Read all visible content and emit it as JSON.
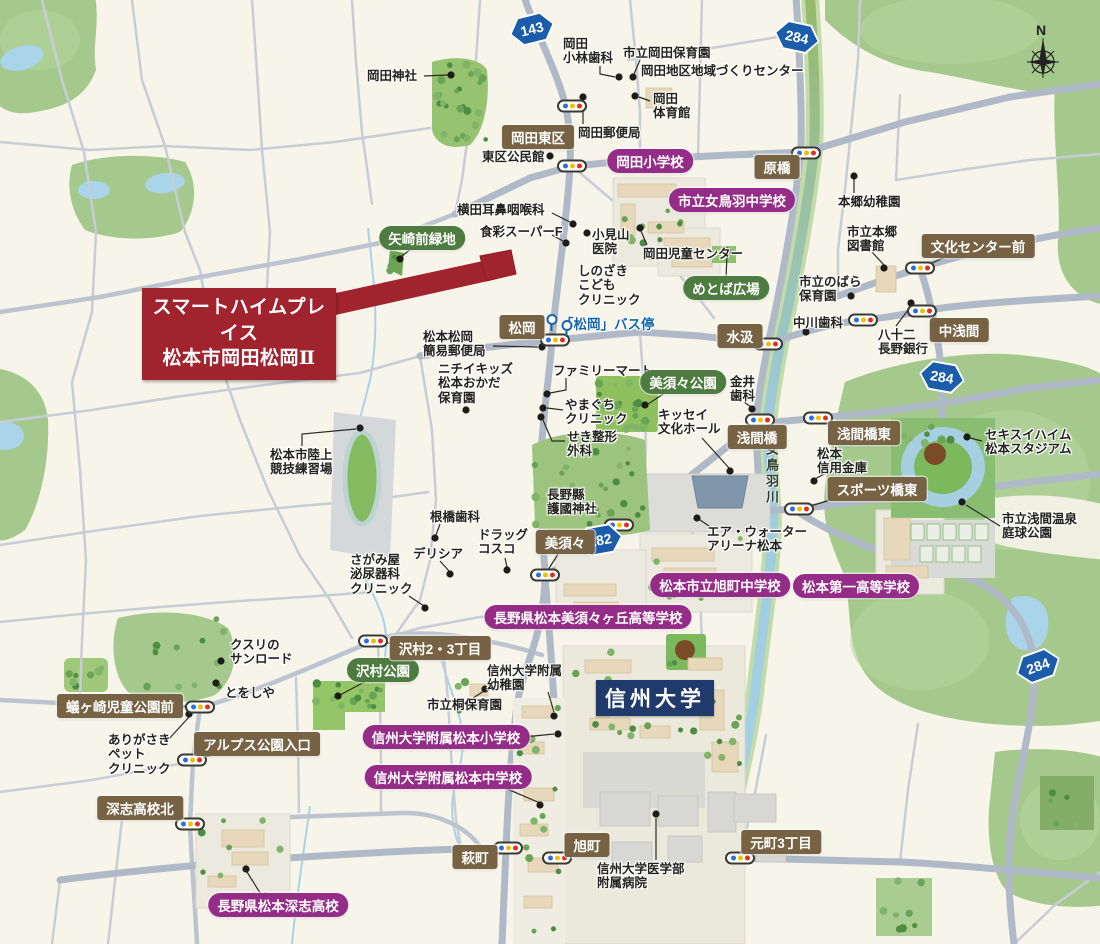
{
  "property": {
    "name_line1": "スマートハイムプレイス",
    "name_line2": "松本市岡田松岡Ⅱ"
  },
  "university": {
    "label": "信州大学"
  },
  "river": {
    "label": "女鳥羽川"
  },
  "compass": {
    "label": "N"
  },
  "bus_stop": {
    "label": "「松岡」バス停",
    "icons": [
      [
        551,
        316
      ],
      [
        566,
        322
      ]
    ]
  },
  "route_shields": [
    {
      "num": "143",
      "x": 532,
      "y": 29,
      "rot": -14
    },
    {
      "num": "284",
      "x": 797,
      "y": 37,
      "rot": 12
    },
    {
      "num": "284",
      "x": 942,
      "y": 377,
      "rot": 10
    },
    {
      "num": "282",
      "x": 600,
      "y": 540,
      "rot": -10
    },
    {
      "num": "284",
      "x": 1038,
      "y": 666,
      "rot": -20
    }
  ],
  "school_badges": [
    {
      "label": "岡田小学校",
      "x": 650,
      "y": 161
    },
    {
      "label": "市立女鳥羽中学校",
      "x": 732,
      "y": 200
    },
    {
      "label": "長野県松本美須々ヶ丘高等学校",
      "x": 588,
      "y": 617
    },
    {
      "label": "松本市立旭町中学校",
      "x": 720,
      "y": 585
    },
    {
      "label": "松本第一高等学校",
      "x": 856,
      "y": 586
    },
    {
      "label": "信州大学附属松本小学校",
      "x": 446,
      "y": 737,
      "dot": [
        558,
        734
      ],
      "leader": [
        [
          524,
          737
        ],
        [
          554,
          734
        ]
      ]
    },
    {
      "label": "信州大学附属松本中学校",
      "x": 448,
      "y": 777,
      "dot": [
        540,
        805
      ],
      "leader": [
        [
          505,
          788
        ],
        [
          540,
          803
        ]
      ]
    },
    {
      "label": "長野県松本深志高校",
      "x": 278,
      "y": 905,
      "dot": [
        246,
        869
      ],
      "leader": [
        [
          262,
          896
        ],
        [
          247,
          872
        ]
      ]
    }
  ],
  "park_badges": [
    {
      "label": "矢崎前緑地",
      "x": 422,
      "y": 238,
      "dot": [
        400,
        259
      ],
      "leader": [
        [
          412,
          248
        ],
        [
          401,
          257
        ]
      ]
    },
    {
      "label": "めとば広場",
      "x": 726,
      "y": 288,
      "dot": [
        727,
        251
      ],
      "leader": [
        [
          726,
          279
        ],
        [
          727,
          254
        ]
      ]
    },
    {
      "label": "美須々公園",
      "x": 683,
      "y": 382,
      "dot": [
        645,
        405
      ],
      "leader": [
        [
          668,
          391
        ],
        [
          648,
          404
        ]
      ]
    },
    {
      "label": "沢村公園",
      "x": 383,
      "y": 670,
      "dot": [
        338,
        696
      ],
      "leader": [
        [
          370,
          679
        ],
        [
          340,
          695
        ]
      ]
    }
  ],
  "place_badges": [
    {
      "label": "岡田東区",
      "x": 538,
      "y": 137
    },
    {
      "label": "原橋",
      "x": 777,
      "y": 167,
      "leader": [
        [
          790,
          160
        ],
        [
          801,
          156
        ]
      ]
    },
    {
      "label": "文化センター前",
      "x": 978,
      "y": 246,
      "leader": [
        [
          952,
          254
        ],
        [
          928,
          265
        ]
      ]
    },
    {
      "label": "中浅間",
      "x": 959,
      "y": 330,
      "leader": [
        [
          942,
          322
        ],
        [
          927,
          314
        ]
      ]
    },
    {
      "label": "水汲",
      "x": 740,
      "y": 336,
      "leader": [
        [
          754,
          338
        ],
        [
          764,
          342
        ]
      ]
    },
    {
      "label": "松岡",
      "x": 522,
      "y": 327,
      "leader": [
        [
          534,
          334
        ],
        [
          550,
          338
        ]
      ]
    },
    {
      "label": "浅間橋",
      "x": 757,
      "y": 437
    },
    {
      "label": "浅間橋東",
      "x": 864,
      "y": 433,
      "leader": [
        [
          846,
          426
        ],
        [
          824,
          420
        ]
      ]
    },
    {
      "label": "スポーツ橋東",
      "x": 877,
      "y": 489,
      "leader": [
        [
          840,
          497
        ],
        [
          804,
          508
        ]
      ]
    },
    {
      "label": "美須々",
      "x": 565,
      "y": 542,
      "leader": [
        [
          560,
          551
        ],
        [
          548,
          570
        ]
      ]
    },
    {
      "label": "沢村2・3丁目",
      "x": 440,
      "y": 648,
      "leader": [
        [
          404,
          646
        ],
        [
          382,
          642
        ]
      ]
    },
    {
      "label": "蟻ヶ崎児童公園前",
      "x": 120,
      "y": 706,
      "leader": [
        [
          180,
          706
        ],
        [
          191,
          707
        ]
      ]
    },
    {
      "label": "アルプス公園入口",
      "x": 257,
      "y": 744,
      "leader": [
        [
          230,
          752
        ],
        [
          198,
          758
        ]
      ]
    },
    {
      "label": "深志高校北",
      "x": 140,
      "y": 808,
      "leader": [
        [
          166,
          816
        ],
        [
          186,
          821
        ]
      ]
    },
    {
      "label": "萩町",
      "x": 475,
      "y": 857,
      "leader": [
        [
          488,
          852
        ],
        [
          500,
          849
        ]
      ]
    },
    {
      "label": "旭町",
      "x": 587,
      "y": 845,
      "leader": [
        [
          573,
          851
        ],
        [
          562,
          856
        ]
      ]
    },
    {
      "label": "元町3丁目",
      "x": 781,
      "y": 842,
      "leader": [
        [
          762,
          850
        ],
        [
          744,
          855
        ]
      ]
    }
  ],
  "poi_labels": [
    {
      "text": "岡田神社",
      "x": 367,
      "y": 69,
      "dot": [
        451,
        75
      ],
      "leader": [
        [
          424,
          76
        ],
        [
          448,
          75
        ]
      ]
    },
    {
      "text": "岡田\n小林歯科",
      "x": 563,
      "y": 37,
      "dot": [
        619,
        77
      ],
      "leader": [
        [
          600,
          66
        ],
        [
          600,
          74
        ],
        [
          615,
          77
        ]
      ]
    },
    {
      "text": "市立岡田保育園",
      "x": 623,
      "y": 46,
      "dot": [
        633,
        77
      ],
      "leader": [
        [
          640,
          60
        ],
        [
          634,
          74
        ]
      ]
    },
    {
      "text": "岡田地区地域づくりセンター",
      "x": 641,
      "y": 64
    },
    {
      "text": "岡田\n体育館",
      "x": 653,
      "y": 92,
      "dot": [
        635,
        96
      ],
      "leader": [
        [
          650,
          101
        ],
        [
          639,
          97
        ]
      ]
    },
    {
      "text": "岡田郵便局",
      "x": 578,
      "y": 126,
      "dot": [
        583,
        97
      ],
      "leader": [
        [
          583,
          124
        ],
        [
          583,
          101
        ]
      ]
    },
    {
      "text": "東区公民館",
      "x": 482,
      "y": 150,
      "dot": [
        550,
        156
      ]
    },
    {
      "text": "横田耳鼻咽喉科",
      "x": 457,
      "y": 203,
      "dot": [
        573,
        224
      ],
      "leader": [
        [
          552,
          213
        ],
        [
          570,
          222
        ]
      ]
    },
    {
      "text": "食彩スーパーF",
      "x": 480,
      "y": 225,
      "dot": [
        566,
        243
      ],
      "leader": [
        [
          552,
          235
        ],
        [
          563,
          241
        ]
      ]
    },
    {
      "text": "小見山\n医院",
      "x": 592,
      "y": 228,
      "dot": [
        587,
        233
      ]
    },
    {
      "text": "岡田児童センター",
      "x": 643,
      "y": 247,
      "dot": [
        640,
        228
      ],
      "leader": [
        [
          647,
          245
        ],
        [
          641,
          231
        ]
      ]
    },
    {
      "text": "しのざき\nこども\nクリニック",
      "x": 578,
      "y": 264
    },
    {
      "text": "本郷幼稚園",
      "x": 838,
      "y": 195,
      "dot": [
        854,
        176
      ],
      "leader": [
        [
          854,
          193
        ],
        [
          854,
          179
        ]
      ]
    },
    {
      "text": "市立本郷\n図書館",
      "x": 847,
      "y": 225,
      "dot": [
        884,
        268
      ],
      "leader": [
        [
          872,
          252
        ],
        [
          884,
          265
        ]
      ]
    },
    {
      "text": "市立のばら\n保育園",
      "x": 799,
      "y": 275,
      "dot": [
        851,
        296
      ]
    },
    {
      "text": "中川歯科",
      "x": 793,
      "y": 316,
      "dot": [
        806,
        332
      ]
    },
    {
      "text": "八十二\n長野銀行",
      "x": 878,
      "y": 328,
      "dot": [
        911,
        303
      ],
      "leader": [
        [
          896,
          326
        ],
        [
          911,
          306
        ]
      ]
    },
    {
      "text": "松本松岡\n簡易郵便局",
      "x": 423,
      "y": 330,
      "dot": [
        542,
        347
      ],
      "leader": [
        [
          493,
          346
        ],
        [
          538,
          347
        ]
      ]
    },
    {
      "text": "ニチイキッズ\n松本おかだ\n保育園",
      "x": 438,
      "y": 362,
      "dot": [
        466,
        410
      ]
    },
    {
      "text": "ファミリーマート",
      "x": 553,
      "y": 364,
      "dot": [
        547,
        394
      ],
      "leader": [
        [
          566,
          378
        ],
        [
          566,
          390
        ],
        [
          550,
          393
        ]
      ]
    },
    {
      "text": "やまぐち\nクリニック",
      "x": 565,
      "y": 398,
      "dot": [
        543,
        408
      ],
      "leader": [
        [
          563,
          410
        ],
        [
          547,
          408
        ]
      ]
    },
    {
      "text": "せき整形\n外科",
      "x": 567,
      "y": 430,
      "dot": [
        541,
        417
      ],
      "leader": [
        [
          565,
          441
        ],
        [
          552,
          441
        ],
        [
          543,
          420
        ]
      ]
    },
    {
      "text": "金井\n歯科",
      "x": 730,
      "y": 375,
      "dot": [
        752,
        409
      ],
      "leader": [
        [
          744,
          402
        ],
        [
          751,
          407
        ]
      ]
    },
    {
      "text": "キッセイ\n文化ホール",
      "x": 658,
      "y": 408,
      "dot": [
        730,
        471
      ],
      "leader": [
        [
          702,
          438
        ],
        [
          729,
          468
        ]
      ]
    },
    {
      "text": "松本市陸上\n競技練習場",
      "x": 270,
      "y": 448,
      "dot": [
        360,
        428
      ],
      "leader": [
        [
          302,
          446
        ],
        [
          302,
          434
        ],
        [
          356,
          429
        ]
      ]
    },
    {
      "text": "根橋歯科",
      "x": 430,
      "y": 510,
      "dot": [
        435,
        538
      ],
      "leader": [
        [
          440,
          524
        ],
        [
          436,
          535
        ]
      ]
    },
    {
      "text": "デリシア",
      "x": 413,
      "y": 547,
      "dot": [
        450,
        574
      ],
      "leader": [
        [
          440,
          561
        ],
        [
          449,
          571
        ]
      ]
    },
    {
      "text": "ドラッグ\nコスコ",
      "x": 478,
      "y": 528,
      "dot": [
        507,
        570
      ],
      "leader": [
        [
          505,
          558
        ],
        [
          507,
          567
        ]
      ]
    },
    {
      "text": "さがみ屋\n泌尿器科\nクリニック",
      "x": 350,
      "y": 553,
      "dot": [
        425,
        608
      ],
      "leader": [
        [
          409,
          596
        ],
        [
          424,
          606
        ]
      ]
    },
    {
      "text": "長野縣\n護國神社",
      "x": 547,
      "y": 488
    },
    {
      "text": "エア・ウォーター\nアリーナ松本",
      "x": 707,
      "y": 525,
      "dot": [
        697,
        518
      ],
      "leader": [
        [
          712,
          528
        ],
        [
          700,
          520
        ]
      ]
    },
    {
      "text": "セキスイハイム\n松本スタジアム",
      "x": 985,
      "y": 428,
      "dot": [
        967,
        437
      ],
      "leader": [
        [
          982,
          441
        ],
        [
          970,
          438
        ]
      ]
    },
    {
      "text": "松本\n信用金庫",
      "x": 817,
      "y": 447,
      "dot": [
        814,
        481
      ],
      "leader": [
        [
          826,
          473
        ],
        [
          815,
          479
        ]
      ]
    },
    {
      "text": "市立浅間温泉\n庭球公園",
      "x": 1002,
      "y": 512,
      "dot": [
        962,
        502
      ],
      "leader": [
        [
          1000,
          526
        ],
        [
          966,
          505
        ]
      ]
    },
    {
      "text": "クスリの\nサンロード",
      "x": 230,
      "y": 638,
      "dot": [
        221,
        661
      ]
    },
    {
      "text": "とをしや",
      "x": 225,
      "y": 686,
      "dot": [
        216,
        683
      ]
    },
    {
      "text": "ありがさき\nペット\nクリニック",
      "x": 108,
      "y": 733,
      "dot": [
        189,
        714
      ],
      "leader": [
        [
          168,
          740
        ],
        [
          189,
          717
        ]
      ]
    },
    {
      "text": "市立桐保育園",
      "x": 427,
      "y": 698,
      "dot": [
        485,
        689
      ],
      "leader": [
        [
          470,
          700
        ],
        [
          484,
          691
        ]
      ]
    },
    {
      "text": "信州大学附属\n幼稚園",
      "x": 487,
      "y": 664,
      "dot": [
        554,
        716
      ],
      "leader": [
        [
          548,
          692
        ],
        [
          554,
          712
        ]
      ]
    },
    {
      "text": "信州大学医学部\n附属病院",
      "x": 597,
      "y": 862,
      "dot": [
        656,
        814
      ],
      "leader": [
        [
          656,
          860
        ],
        [
          656,
          818
        ]
      ]
    }
  ],
  "signals": [
    [
      572,
      106
    ],
    [
      572,
      166
    ],
    [
      806,
      153
    ],
    [
      920,
      268
    ],
    [
      922,
      311
    ],
    [
      863,
      320
    ],
    [
      768,
      344
    ],
    [
      555,
      340
    ],
    [
      760,
      420
    ],
    [
      818,
      418
    ],
    [
      799,
      509
    ],
    [
      619,
      525
    ],
    [
      545,
      575
    ],
    [
      373,
      641
    ],
    [
      200,
      707
    ],
    [
      192,
      760
    ],
    [
      190,
      824
    ],
    [
      508,
      848
    ],
    [
      557,
      858
    ],
    [
      740,
      858
    ]
  ],
  "colors": {
    "background": "#f7f4ea",
    "road": "#afb9c7",
    "road_minor": "#c6cdd6",
    "forest": "#a5c98d",
    "park": "#94c566",
    "river_top": "#9aba6d",
    "river_bottom": "#a8d4e8",
    "school_badge": "#952c87",
    "park_badge": "#4e7b3f",
    "place_badge": "#776343",
    "property_red": "#a1232d",
    "university_navy": "#203a6c",
    "route_blue": "#1b5cab",
    "signal_blue": "#2e6fd6",
    "signal_yellow": "#f0c000",
    "signal_red": "#e03020",
    "bus_blue": "#1566b0"
  }
}
